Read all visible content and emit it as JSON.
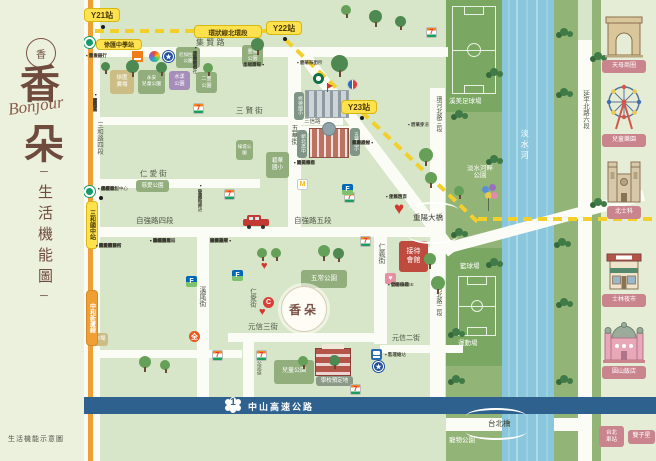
{
  "colors": {
    "map_bg": "#d7e5c8",
    "sidebar_bg": "#ecf1dd",
    "panel_bg": "#e6edd6",
    "road": "#fcfcf6",
    "river": "#8ac7dc",
    "green_strip": "#93b477",
    "green_dark": "#7aa761",
    "park_block": "#92ae7c",
    "purple_block": "#a58fba",
    "tan_block": "#cbbd84",
    "red_block": "#bf4a3e",
    "metro_orange": "#f09f35",
    "ring_yellow": "#f2cf2a",
    "badge_yellow": "#ffe24d",
    "highway_blue": "#2f618e",
    "brand_brown": "#6f4b3e",
    "pink_label": "#c9848e"
  },
  "sidebar": {
    "logo_char": "香",
    "title_top": "香",
    "script": "Bonjour",
    "title_bottom": "朵",
    "subtitle": "生活機能圖",
    "dash": "─",
    "footer": "生活機能示意圖"
  },
  "site": {
    "label": "香朵",
    "x": 281,
    "y": 286,
    "d": 46
  },
  "highway": {
    "label": "中山高速公路",
    "num": "1"
  },
  "river": {
    "name": "淡水河"
  },
  "zones": [
    {
      "x": 0,
      "y": 0,
      "w": 656,
      "h": 461,
      "c": "#d7e5c8",
      "n": "map-background"
    },
    {
      "x": 446,
      "y": 0,
      "w": 56,
      "h": 398,
      "c": "#93b477",
      "n": "riverside-strip-west"
    },
    {
      "x": 446,
      "y": 0,
      "w": 56,
      "h": 112,
      "c": "#7aa761",
      "n": "soccer-field-zone"
    },
    {
      "x": 446,
      "y": 248,
      "w": 56,
      "h": 118,
      "c": "#7aa761",
      "n": "sports-zone"
    },
    {
      "x": 554,
      "y": 0,
      "w": 24,
      "h": 398,
      "c": "#93b477",
      "n": "riverside-strip-east"
    },
    {
      "x": 592,
      "y": 0,
      "w": 9,
      "h": 398,
      "c": "#93b477",
      "n": "riverside-strip-east2"
    },
    {
      "x": 502,
      "y": 0,
      "w": 52,
      "h": 461,
      "c": "#8ac7dc",
      "n": "tamsui-river"
    },
    {
      "x": 446,
      "y": 414,
      "w": 56,
      "h": 47,
      "c": "#93b477",
      "n": "pet-park-zone"
    },
    {
      "x": 554,
      "y": 414,
      "w": 24,
      "h": 47,
      "c": "#93b477",
      "n": "riverside-strip-south"
    },
    {
      "x": 592,
      "y": 414,
      "w": 9,
      "h": 47,
      "c": "#93b477",
      "n": "riverside-strip-south2"
    },
    {
      "x": 601,
      "y": 0,
      "w": 55,
      "h": 461,
      "c": "#e6edd6",
      "n": "landmark-panel"
    }
  ],
  "roads": [
    {
      "x": 82,
      "y": 0,
      "w": 18,
      "h": 461
    },
    {
      "x": 288,
      "y": 48,
      "w": 13,
      "h": 186
    },
    {
      "x": 197,
      "y": 234,
      "w": 12,
      "h": 166
    },
    {
      "x": 374,
      "y": 232,
      "w": 13,
      "h": 112
    },
    {
      "x": 430,
      "y": 88,
      "w": 15,
      "h": 310
    },
    {
      "x": 578,
      "y": 40,
      "w": 14,
      "h": 358
    },
    {
      "x": 243,
      "y": 342,
      "w": 11,
      "h": 56
    },
    {
      "x": 578,
      "y": 414,
      "w": 14,
      "h": 47
    },
    {
      "x": 82,
      "y": 47,
      "w": 366,
      "h": 10
    },
    {
      "x": 95,
      "y": 117,
      "w": 248,
      "h": 8
    },
    {
      "x": 298,
      "y": 126,
      "w": 62,
      "h": 7
    },
    {
      "x": 82,
      "y": 179,
      "w": 178,
      "h": 9
    },
    {
      "x": 82,
      "y": 227,
      "w": 362,
      "h": 10
    },
    {
      "x": 228,
      "y": 333,
      "w": 152,
      "h": 9
    },
    {
      "x": 380,
      "y": 345,
      "w": 83,
      "h": 8
    },
    {
      "x": 82,
      "y": 350,
      "w": 160,
      "h": 8
    },
    {
      "x": 300,
      "y": 44,
      "w": 254,
      "h": 12,
      "a": 53
    },
    {
      "x": 412,
      "y": 252,
      "w": 240,
      "h": 11,
      "a": -15
    },
    {
      "x": 446,
      "y": 418,
      "w": 56,
      "h": 13
    },
    {
      "x": 554,
      "y": 418,
      "w": 24,
      "h": 13
    }
  ],
  "metro_line": {
    "x": 88,
    "w": 5,
    "c": "#f09f35",
    "label": "中和新蘆線"
  },
  "dashes": [
    {
      "x": 95,
      "y": 29,
      "len": 205,
      "a": 0
    },
    {
      "x": 286,
      "y": 38,
      "len": 264,
      "a": 43.5
    },
    {
      "x": 478,
      "y": 217,
      "len": 178,
      "a": 0
    }
  ],
  "badges": [
    {
      "t": "Y21站",
      "x": 84,
      "y": 8,
      "w": 36,
      "h": 14,
      "fs": 8,
      "n": "station-badge-y21"
    },
    {
      "t": "Y22站",
      "x": 266,
      "y": 21,
      "w": 36,
      "h": 14,
      "fs": 8,
      "n": "station-badge-y22"
    },
    {
      "t": "Y23站",
      "x": 341,
      "y": 100,
      "w": 36,
      "h": 14,
      "fs": 8,
      "n": "station-badge-y23"
    },
    {
      "t": "環狀線北環段",
      "x": 194,
      "y": 25,
      "w": 68,
      "h": 13,
      "fs": 6.5,
      "n": "ring-line-label"
    },
    {
      "t": "徐匯中學站",
      "x": 96,
      "y": 39,
      "w": 46,
      "h": 11,
      "fs": 6,
      "n": "station-badge-xuhui"
    },
    {
      "t": "三和國中站",
      "x": 86,
      "y": 201,
      "w": 12,
      "h": 48,
      "fs": 6,
      "v": true,
      "n": "station-badge-sanhe"
    },
    {
      "t": "中和新蘆線",
      "x": 86,
      "y": 290,
      "w": 12,
      "h": 56,
      "fs": 6,
      "v": true,
      "bg": "#f09f35",
      "fg": "#fff",
      "bd": "#d88a20",
      "n": "metro-line-badge"
    }
  ],
  "dots": [
    {
      "x": 101,
      "y": 25
    },
    {
      "x": 283,
      "y": 37
    },
    {
      "x": 360,
      "y": 116
    },
    {
      "x": 99,
      "y": 196
    }
  ],
  "metro_logos": [
    {
      "x": 84,
      "y": 37
    },
    {
      "x": 84,
      "y": 186
    }
  ],
  "labels": [
    {
      "t": "集 賢 路",
      "x": 196,
      "y": 38,
      "fs": 8
    },
    {
      "t": "三 賢 街",
      "x": 236,
      "y": 107,
      "fs": 7.5
    },
    {
      "t": "三信路",
      "x": 304,
      "y": 119,
      "fs": 5.5
    },
    {
      "t": "五華街",
      "x": 290,
      "y": 124,
      "fs": 7,
      "v": true
    },
    {
      "t": "仁 愛 街",
      "x": 140,
      "y": 170,
      "fs": 7.5
    },
    {
      "t": "自強路四段",
      "x": 136,
      "y": 217,
      "fs": 7.5
    },
    {
      "t": "自強路五段",
      "x": 294,
      "y": 217,
      "fs": 7.5
    },
    {
      "t": "仁愛街",
      "x": 248,
      "y": 288,
      "fs": 6.5,
      "v": true
    },
    {
      "t": "溪尾街",
      "x": 198,
      "y": 286,
      "fs": 7,
      "v": true
    },
    {
      "t": "仁義街",
      "x": 377,
      "y": 243,
      "fs": 7,
      "v": true
    },
    {
      "t": "元信三街",
      "x": 248,
      "y": 323,
      "fs": 7.5
    },
    {
      "t": "元信二街",
      "x": 392,
      "y": 335,
      "fs": 7
    },
    {
      "t": "三和路四段",
      "x": 95,
      "y": 122,
      "fs": 6.5,
      "v": true
    },
    {
      "t": "三重交流道",
      "x": 255,
      "y": 350,
      "fs": 5,
      "v": true
    },
    {
      "t": "環河北路三段",
      "x": 434,
      "y": 96,
      "fs": 6,
      "v": true
    },
    {
      "t": "環河北路二段",
      "x": 434,
      "y": 280,
      "fs": 6,
      "v": true
    },
    {
      "t": "延平北路六段",
      "x": 581,
      "y": 90,
      "fs": 6.5,
      "v": true
    },
    {
      "t": "重陽大橋",
      "x": 413,
      "y": 214,
      "fs": 7.5,
      "c": "#3d4236"
    },
    {
      "t": "台北橋",
      "x": 488,
      "y": 420,
      "fs": 7.5,
      "c": "#3d4236"
    },
    {
      "t": "淡水河",
      "x": 520,
      "y": 129,
      "fs": 8,
      "c": "#ffffff",
      "v": true,
      "ls": 3
    },
    {
      "t": "溪美足球場",
      "x": 449,
      "y": 98,
      "fs": 6.5,
      "c": "#ffffff"
    },
    {
      "t": "淡水河畔\n公園",
      "x": 456,
      "y": 165,
      "fs": 6.5,
      "c": "#ffffff",
      "w": 48,
      "ctr": true
    },
    {
      "t": "籃球場",
      "x": 460,
      "y": 263,
      "fs": 6.5,
      "c": "#ffffff"
    },
    {
      "t": "運動場",
      "x": 458,
      "y": 340,
      "fs": 6.5,
      "c": "#ffffff"
    },
    {
      "t": "寵物公園",
      "x": 449,
      "y": 437,
      "fs": 6.5,
      "c": "#ffffff"
    }
  ],
  "blocks": [
    {
      "t": "徐匯\n廣場",
      "x": 110,
      "y": 70,
      "w": 24,
      "h": 24,
      "bg": "#cbbd84",
      "fs": 5.5,
      "n": "xuhui-plaza-block"
    },
    {
      "t": "永安\n兒童公園",
      "x": 138,
      "y": 70,
      "w": 27,
      "h": 24,
      "fs": 4.8,
      "n": "yongan-childrens-park-block"
    },
    {
      "t": "水漾\n公園",
      "x": 169,
      "y": 71,
      "w": 21,
      "h": 19,
      "bg": "#a58fba",
      "fs": 5,
      "n": "shuiyang-park-block"
    },
    {
      "t": "尼加拉瓜\n公園",
      "x": 176,
      "y": 47,
      "w": 24,
      "h": 21,
      "fs": 4.5,
      "n": "nicaragua-park-block"
    },
    {
      "t": "二重\n公園",
      "x": 196,
      "y": 72,
      "w": 21,
      "h": 21,
      "fs": 5,
      "n": "erchong-park-block"
    },
    {
      "t": "重陽\n公園",
      "x": 242,
      "y": 45,
      "w": 21,
      "h": 21,
      "fs": 5,
      "n": "chongyang-park-block"
    },
    {
      "t": "慈愛公園",
      "x": 136,
      "y": 180,
      "w": 33,
      "h": 12,
      "fs": 5.5,
      "n": "ciai-park-block"
    },
    {
      "t": "綠堤公園",
      "x": 236,
      "y": 140,
      "w": 17,
      "h": 20,
      "fs": 4.5,
      "n": "ludi-park-block"
    },
    {
      "t": "市場",
      "x": 92,
      "y": 333,
      "w": 16,
      "h": 13,
      "bg": "#cbbd84",
      "fs": 5.5,
      "n": "market-block"
    },
    {
      "t": "五常公園",
      "x": 301,
      "y": 270,
      "w": 46,
      "h": 18,
      "fs": 6.5,
      "n": "wuchang-park-block"
    },
    {
      "t": "兒童公園",
      "x": 274,
      "y": 360,
      "w": 40,
      "h": 24,
      "fs": 6,
      "n": "childrens-park-block"
    },
    {
      "t": "碧華\n國小",
      "x": 266,
      "y": 152,
      "w": 23,
      "h": 26,
      "fs": 5.5,
      "n": "bihua-elementary-block"
    },
    {
      "t": "接待\n會館",
      "x": 399,
      "y": 241,
      "w": 29,
      "h": 31,
      "bg": "#bf4a3e",
      "fs": 7,
      "n": "reception-hall-block"
    },
    {
      "t": "學校預定地",
      "x": 316,
      "y": 376,
      "w": 37,
      "h": 10,
      "bg": "#8b9a88",
      "fs": 5.5,
      "n": "planned-school-tag"
    },
    {
      "t": "修德國小",
      "x": 294,
      "y": 92,
      "w": 10,
      "h": 28,
      "bg": "#7f9585",
      "fs": 4.8,
      "v": true,
      "n": "xiude-elementary-tag"
    },
    {
      "t": "新北高中",
      "x": 297,
      "y": 130,
      "w": 10,
      "h": 28,
      "bg": "#7f9585",
      "fs": 4.8,
      "v": true,
      "n": "xinbei-highschool-tag"
    },
    {
      "t": "五華國小",
      "x": 350,
      "y": 128,
      "w": 10,
      "h": 28,
      "bg": "#7f9585",
      "fs": 4.8,
      "v": true,
      "n": "wuhua-elementary-tag"
    }
  ],
  "schools": [
    {
      "k": "grey",
      "x": 305,
      "y": 90,
      "w": 44,
      "h": 28,
      "n": "school-building-illustration"
    },
    {
      "k": "brick",
      "x": 309,
      "y": 128,
      "w": 40,
      "h": 30,
      "n": "highschool-building-illustration"
    },
    {
      "k": "red",
      "x": 315,
      "y": 348,
      "w": 36,
      "h": 28,
      "n": "planned-school-building-illustration"
    }
  ],
  "fields": [
    {
      "k": "soccer",
      "x": 452,
      "y": 6,
      "w": 44,
      "h": 88,
      "n": "soccer-field"
    },
    {
      "k": "basket",
      "x": 458,
      "y": 276,
      "w": 38,
      "h": 60,
      "n": "basketball-court"
    }
  ],
  "brackets": [
    {
      "x": 408,
      "y": 202,
      "w": 50,
      "d": "up"
    },
    {
      "x": 408,
      "y": 236,
      "w": 50,
      "d": "dn"
    },
    {
      "x": 466,
      "y": 408,
      "w": 60,
      "d": "up"
    },
    {
      "x": 466,
      "y": 432,
      "w": 60,
      "d": "dn"
    }
  ],
  "landmarks": [
    {
      "k": "arc",
      "label": "天母商圈",
      "x": 604,
      "y": 14,
      "w": 40,
      "h": 44,
      "lx": 602,
      "ly": 60,
      "lw": 44,
      "n": "arc-de-triomphe-icon"
    },
    {
      "k": "ferris",
      "label": "兒童樂園",
      "x": 602,
      "y": 82,
      "w": 44,
      "h": 50,
      "lx": 602,
      "ly": 134,
      "lw": 44,
      "n": "ferris-wheel-icon"
    },
    {
      "k": "cath",
      "label": "北士科",
      "x": 604,
      "y": 156,
      "w": 40,
      "h": 48,
      "lx": 607,
      "ly": 206,
      "lw": 34,
      "n": "cathedral-icon"
    },
    {
      "k": "shop",
      "label": "士林夜市",
      "x": 604,
      "y": 246,
      "w": 40,
      "h": 46,
      "lx": 602,
      "ly": 294,
      "lw": 44,
      "n": "night-market-shop-icon"
    },
    {
      "k": "basil",
      "label": "圓山飯店",
      "x": 602,
      "y": 316,
      "w": 44,
      "h": 48,
      "lx": 602,
      "ly": 366,
      "lw": 44,
      "n": "grand-hotel-icon"
    }
  ],
  "pills": [
    {
      "t": "台北\n車站",
      "x": 599,
      "y": 426,
      "w": 25,
      "h": 21,
      "fs": 5.5,
      "n": "taipei-main-station-pill"
    },
    {
      "t": "雙子星",
      "x": 628,
      "y": 430,
      "w": 27,
      "h": 14,
      "fs": 6,
      "n": "twin-towers-pill"
    }
  ],
  "logos": [
    {
      "k": "seven",
      "x": 193,
      "y": 103
    },
    {
      "k": "seven",
      "x": 224,
      "y": 189
    },
    {
      "k": "seven",
      "x": 344,
      "y": 192
    },
    {
      "k": "seven",
      "x": 360,
      "y": 236
    },
    {
      "k": "seven",
      "x": 426,
      "y": 27
    },
    {
      "k": "seven",
      "x": 212,
      "y": 350
    },
    {
      "k": "seven",
      "x": 256,
      "y": 350
    },
    {
      "k": "seven",
      "x": 350,
      "y": 384
    },
    {
      "k": "family",
      "x": 186,
      "y": 276
    },
    {
      "k": "family",
      "x": 232,
      "y": 270
    },
    {
      "k": "family",
      "x": 342,
      "y": 184
    },
    {
      "k": "carrefour",
      "x": 347,
      "y": 79
    },
    {
      "k": "redc",
      "x": 263,
      "y": 297
    },
    {
      "k": "px",
      "x": 189,
      "y": 331
    },
    {
      "k": "mcd",
      "x": 297,
      "y": 179
    },
    {
      "k": "sbux",
      "x": 313,
      "y": 73
    },
    {
      "k": "flower",
      "x": 149,
      "y": 51
    },
    {
      "k": "orangebox",
      "x": 132,
      "y": 51
    },
    {
      "k": "shield",
      "x": 163,
      "y": 51
    },
    {
      "k": "shield",
      "x": 373,
      "y": 361
    },
    {
      "k": "train",
      "x": 371,
      "y": 349
    },
    {
      "k": "drug",
      "x": 385,
      "y": 273
    },
    {
      "k": "heart",
      "x": 394,
      "y": 200,
      "s": 17
    },
    {
      "k": "heart",
      "x": 261,
      "y": 261,
      "s": 11
    },
    {
      "k": "heart",
      "x": 259,
      "y": 307,
      "s": 11
    }
  ],
  "trees": [
    {
      "x": 126,
      "y": 60,
      "s": 13
    },
    {
      "x": 156,
      "y": 62,
      "s": 11
    },
    {
      "x": 203,
      "y": 63,
      "s": 10
    },
    {
      "x": 251,
      "y": 38,
      "s": 13
    },
    {
      "x": 331,
      "y": 55,
      "s": 17
    },
    {
      "x": 369,
      "y": 10,
      "s": 13
    },
    {
      "x": 395,
      "y": 16,
      "s": 11
    },
    {
      "x": 341,
      "y": 5,
      "s": 10
    },
    {
      "x": 419,
      "y": 148,
      "s": 14
    },
    {
      "x": 425,
      "y": 172,
      "s": 12
    },
    {
      "x": 257,
      "y": 248,
      "s": 10
    },
    {
      "x": 271,
      "y": 248,
      "s": 10
    },
    {
      "x": 318,
      "y": 245,
      "s": 12
    },
    {
      "x": 333,
      "y": 248,
      "s": 11
    },
    {
      "x": 424,
      "y": 253,
      "s": 12
    },
    {
      "x": 431,
      "y": 276,
      "s": 14
    },
    {
      "x": 298,
      "y": 356,
      "s": 10
    },
    {
      "x": 329,
      "y": 355,
      "s": 11
    },
    {
      "x": 139,
      "y": 356,
      "s": 12
    },
    {
      "x": 160,
      "y": 360,
      "s": 10
    },
    {
      "x": 101,
      "y": 62,
      "s": 9
    },
    {
      "x": 454,
      "y": 186,
      "s": 10
    }
  ],
  "bushes": [
    {
      "x": 455,
      "y": 110
    },
    {
      "x": 490,
      "y": 68
    },
    {
      "x": 455,
      "y": 228
    },
    {
      "x": 490,
      "y": 258
    },
    {
      "x": 452,
      "y": 328
    },
    {
      "x": 560,
      "y": 28
    },
    {
      "x": 560,
      "y": 88
    },
    {
      "x": 558,
      "y": 238
    },
    {
      "x": 560,
      "y": 298
    },
    {
      "x": 594,
      "y": 52
    },
    {
      "x": 594,
      "y": 198
    },
    {
      "x": 560,
      "y": 375
    },
    {
      "x": 452,
      "y": 375
    },
    {
      "x": 490,
      "y": 155
    }
  ],
  "autumn_trees": [
    {
      "x": 12,
      "y": 312,
      "s": 22,
      "c": "#d9642e"
    },
    {
      "x": 36,
      "y": 326,
      "s": 26,
      "c": "#e0772f"
    },
    {
      "x": 18,
      "y": 350,
      "s": 16,
      "c": "#8a8a3c"
    },
    {
      "x": 44,
      "y": 352,
      "s": 18,
      "c": "#a06b2a"
    }
  ],
  "clusters": [
    {
      "x": 86,
      "y": 53,
      "dir": "h",
      "items": [
        "國泰銀行",
        "兆豐銀行",
        "第一銀行",
        "元大銀行"
      ]
    },
    {
      "x": 198,
      "y": 45,
      "dir": "v",
      "items": [
        "集賢郵局",
        "農會超市",
        "全聯福利社",
        "運動中心"
      ]
    },
    {
      "x": 243,
      "y": 62,
      "dir": "hr",
      "w": 40,
      "items": [
        "土地銀行",
        "晶冠廣場",
        "幸福市場"
      ]
    },
    {
      "x": 297,
      "y": 60,
      "dir": "h",
      "items": [
        "重陽派出所",
        "碧華布街"
      ]
    },
    {
      "x": 98,
      "y": 92,
      "dir": "v",
      "items": [
        "麥當勞",
        "肯德基",
        "星巴克",
        "屈臣氏",
        "康是美",
        "寶雅"
      ]
    },
    {
      "x": 98,
      "y": 186,
      "dir": "h",
      "items": [
        "全聯福利中心",
        "屈臣氏",
        "燦坤3C",
        "美廉社",
        "曼都髮型",
        "85度C"
      ]
    },
    {
      "x": 203,
      "y": 183,
      "dir": "v",
      "items": [
        "何嘉仁美語",
        "佳音英語",
        "安親班"
      ]
    },
    {
      "x": 150,
      "y": 238,
      "dir": "h",
      "items": [
        "寶雅生活館",
        "路易莎咖啡",
        "八方雲集",
        "爭鮮壽司",
        "石二鍋",
        "拿坡里",
        "50嵐",
        "大呼過癮"
      ]
    },
    {
      "x": 210,
      "y": 238,
      "dir": "hr",
      "w": 40,
      "items": [
        "國泰診所",
        "維康藥局",
        "長青藥局",
        "動物醫院",
        "牙醫診所",
        "眼科診所"
      ]
    },
    {
      "x": 96,
      "y": 243,
      "dir": "h",
      "items": [
        "台電服務所",
        "仁愛眼科",
        "欣欣瓦斯",
        "黃昏市場",
        "戶政事務所",
        "地政事務所",
        "衛生所",
        "圖書館分館"
      ]
    },
    {
      "x": 294,
      "y": 160,
      "dir": "h",
      "items": [
        "義天宮",
        "活動中心",
        "集美商圈",
        "聯邦銀行",
        "陸光市場"
      ]
    },
    {
      "x": 352,
      "y": 140,
      "dir": "hr",
      "w": 40,
      "items": [
        "臺灣銀行",
        "郵局ATM",
        "美廉社",
        "永慶房屋",
        "信義房屋"
      ]
    },
    {
      "x": 386,
      "y": 194,
      "dir": "h",
      "items": [
        "佳瑪百貨",
        "生鮮超市",
        "早餐坊"
      ]
    },
    {
      "x": 388,
      "y": 282,
      "dir": "h",
      "items": [
        "自助洗衣",
        "髮廊沙龍",
        "VT HOUSE",
        "公園綠地"
      ]
    },
    {
      "x": 385,
      "y": 352,
      "dir": "h",
      "items": [
        "監理站",
        "客運總站"
      ]
    },
    {
      "x": 408,
      "y": 122,
      "dir": "h",
      "items": [
        "碧華寺",
        "河濱步道"
      ]
    }
  ],
  "misc": {
    "car": {
      "x": 241,
      "y": 215
    },
    "balloons": {
      "x": 478,
      "y": 184
    },
    "highway_band": {
      "y": 397,
      "h": 17
    },
    "highway_label_x": 248,
    "highway_label_y": 400,
    "shield_x": 224,
    "shield_y": 396
  }
}
